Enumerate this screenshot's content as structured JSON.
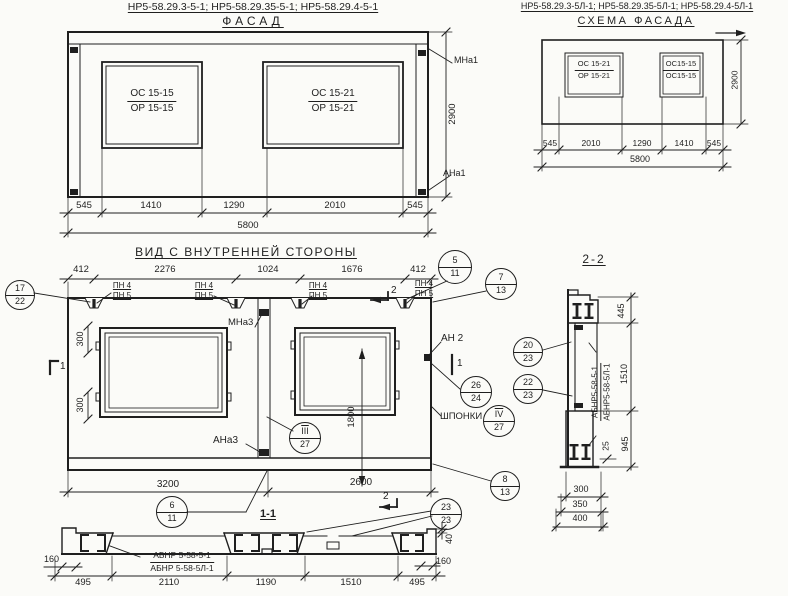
{
  "colors": {
    "ink": "#1f1f1f",
    "paper": "#fbfbf8"
  },
  "titles": {
    "facade_codes": "НР5-58.29.3-5-1; НР5-58.29.35-5-1; НР5-58.29.4-5-1",
    "facade": "ФАСАД",
    "schema_codes": "НР5-58.29.3-5Л-1; НР5-58.29.35-5Л-1; НР5-58.29.4-5Л-1",
    "schema": "СХЕМА ФАСАДА",
    "inner": "ВИД С ВНУТРЕННЕЙ СТОРОНЫ",
    "s11": "1-1",
    "s22": "2-2"
  },
  "facade": {
    "win_left_top": "ОС 15-15",
    "win_left_bot": "ОР 15-15",
    "win_right_top": "ОС 15-21",
    "win_right_bot": "ОР 15-21",
    "dims": [
      "545",
      "1410",
      "1290",
      "2010",
      "545"
    ],
    "total": "5800",
    "height": "2900",
    "mark_top": "МНа1",
    "mark_bot": "АНа1"
  },
  "schema": {
    "win_left_top": "ОС 15-21",
    "win_left_bot": "ОР 15-21",
    "win_right_top": "ОС15-15",
    "win_right_bot": "ОС15-15",
    "dims": [
      "545",
      "2010",
      "1290",
      "1410",
      "545"
    ],
    "total": "5800",
    "height": "2900"
  },
  "inner": {
    "dims_top": [
      "412",
      "2276",
      "1024",
      "1676",
      "412"
    ],
    "pn4": "ПН 4",
    "pn5": "ПН 5",
    "dim300a": "300",
    "dim300b": "300",
    "dim1800": "1800",
    "mna3": "МНа3",
    "ana3": "АНа3",
    "an2": "АН 2",
    "shponki": "ШПОНКИ",
    "dims_bottom": [
      "3200",
      "2600"
    ],
    "sec1": "1",
    "sec2": "2"
  },
  "callouts": {
    "c17_22": {
      "t": "17",
      "b": "22"
    },
    "c5_11": {
      "t": "5",
      "b": "11"
    },
    "c7_13": {
      "t": "7",
      "b": "13"
    },
    "c20_23": {
      "t": "20",
      "b": "23"
    },
    "c22_23": {
      "t": "22",
      "b": "23"
    },
    "c26_24": {
      "t": "26",
      "b": "24"
    },
    "c4_27": {
      "t": "IV",
      "b": "27"
    },
    "c3_27": {
      "t": "III",
      "b": "27"
    },
    "c8_13": {
      "t": "8",
      "b": "13"
    },
    "c6_11": {
      "t": "6",
      "b": "11"
    },
    "c23_23": {
      "t": "23",
      "b": "23"
    }
  },
  "s11": {
    "label1": "АБНР 5-58-5-1",
    "label2": "АБНР 5-58-5Л-1",
    "dims": [
      "495",
      "2110",
      "1190",
      "1510",
      "495"
    ],
    "dim160l": "160",
    "dim160r": "160",
    "dim40": "40"
  },
  "s22": {
    "label1": "АБНР5-58-5-1",
    "label2": "АБНР5-58-5Л-1",
    "dim445": "445",
    "dim1510": "1510",
    "dim945": "945",
    "dim25": "25",
    "dims_bottom": [
      "300",
      "350",
      "400"
    ]
  }
}
